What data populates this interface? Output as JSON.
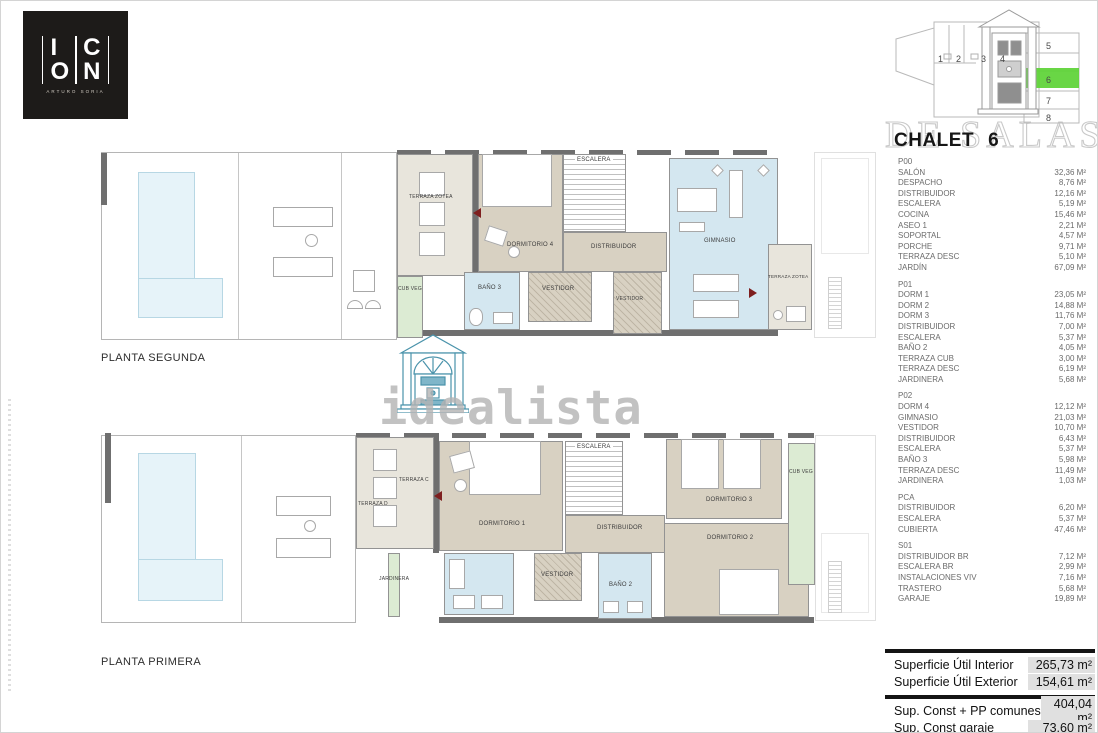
{
  "logo": {
    "row1": [
      "I",
      "C"
    ],
    "row2": [
      "O",
      "N"
    ],
    "subtitle": "ARTURO SORIA"
  },
  "title": {
    "name": "CHALET",
    "number": "6"
  },
  "watermark": {
    "brand": "idealista",
    "agency": "DE SALAS"
  },
  "site_plan": {
    "plots": [
      "1",
      "2",
      "3",
      "4",
      "5",
      "6",
      "7",
      "8"
    ],
    "highlighted": "6",
    "highlight_color": "#5cd335"
  },
  "floor_labels": {
    "upper": "PLANTA SEGUNDA",
    "lower": "PLANTA PRIMERA"
  },
  "plan_upper": {
    "rooms": {
      "terraza_zotea_left": "TERRAZA ZOTEA",
      "cub_veg": "CUB VEG",
      "dormitorio4": "DORMITORIO 4",
      "escalera": "ESCALERA",
      "distribuidor": "DISTRIBUIDOR",
      "bano3": "BAÑO 3",
      "vestidor1": "VESTIDOR",
      "vestidor2": "VESTIDOR",
      "gimnasio": "GIMNASIO",
      "terraza_zotea_right": "TERRAZA ZOTEA"
    }
  },
  "plan_lower": {
    "rooms": {
      "terraza_c": "TERRAZA C",
      "terraza_d": "TERRAZA D",
      "jardinera": "JARDINERA",
      "dormitorio1": "DORMITORIO 1",
      "escalera": "ESCALERA",
      "distribuidor": "DISTRIBUIDOR",
      "vestidor": "VESTIDOR",
      "bano2": "BAÑO 2",
      "dormitorio3": "DORMITORIO 3",
      "dormitorio2": "DORMITORIO 2",
      "cub_veg": "CUB VEG"
    }
  },
  "area_sections": [
    {
      "code": "P00",
      "rows": [
        {
          "label": "SALÓN",
          "value": "32,36 M²"
        },
        {
          "label": "DESPACHO",
          "value": "8,76 M²"
        },
        {
          "label": "DISTRIBUIDOR",
          "value": "12,16 M²"
        },
        {
          "label": "ESCALERA",
          "value": "5,19 M²"
        },
        {
          "label": "COCINA",
          "value": "15,46 M²"
        },
        {
          "label": "ASEO 1",
          "value": "2,21 M²"
        },
        {
          "label": "SOPORTAL",
          "value": "4,57 M²"
        },
        {
          "label": "PORCHE",
          "value": "9,71 M²"
        },
        {
          "label": "TERRAZA DESC",
          "value": "5,10 M²"
        },
        {
          "label": "JARDÍN",
          "value": "67,09 M²"
        }
      ]
    },
    {
      "code": "P01",
      "rows": [
        {
          "label": "DORM 1",
          "value": "23,05 M²"
        },
        {
          "label": "DORM 2",
          "value": "14,88 M²"
        },
        {
          "label": "DORM 3",
          "value": "11,76 M²"
        },
        {
          "label": "DISTRIBUIDOR",
          "value": "7,00 M²"
        },
        {
          "label": "ESCALERA",
          "value": "5,37 M²"
        },
        {
          "label": "BAÑO 2",
          "value": "4,05 M²"
        },
        {
          "label": "TERRAZA CUB",
          "value": "3,00 M²"
        },
        {
          "label": "TERRAZA DESC",
          "value": "6,19 M²"
        },
        {
          "label": "JARDINERA",
          "value": "5,68 M²"
        }
      ]
    },
    {
      "code": "P02",
      "rows": [
        {
          "label": "DORM 4",
          "value": "12,12 M²"
        },
        {
          "label": "GIMNASIO",
          "value": "21,03 M²"
        },
        {
          "label": "VESTIDOR",
          "value": "10,70 M²"
        },
        {
          "label": "DISTRIBUIDOR",
          "value": "6,43 M²"
        },
        {
          "label": "ESCALERA",
          "value": "5,37 M²"
        },
        {
          "label": "BAÑO 3",
          "value": "5,98 M²"
        },
        {
          "label": "TERRAZA DESC",
          "value": "11,49 M²"
        },
        {
          "label": "JARDINERA",
          "value": "1,03 M²"
        }
      ]
    },
    {
      "code": "PCA",
      "rows": [
        {
          "label": "DISTRIBUIDOR",
          "value": "6,20 M²"
        },
        {
          "label": "ESCALERA",
          "value": "5,37 M²"
        },
        {
          "label": "CUBIERTA",
          "value": "47,46 M²"
        }
      ]
    },
    {
      "code": "S01",
      "rows": [
        {
          "label": "DISTRIBUIDOR BR",
          "value": "7,12 M²"
        },
        {
          "label": "ESCALERA BR",
          "value": "2,99 M²"
        },
        {
          "label": "INSTALACIONES VIV",
          "value": "7,16 M²"
        },
        {
          "label": "TRASTERO",
          "value": "5,68 M²"
        },
        {
          "label": "GARAJE",
          "value": "19,89 M²"
        }
      ]
    }
  ],
  "summary": {
    "groups": [
      [
        {
          "label": "Superficie Útil Interior",
          "value": "265,73 m²"
        },
        {
          "label": "Superficie Útil Exterior",
          "value": "154,61 m²"
        }
      ],
      [
        {
          "label": "Sup. Const + PP comunes",
          "value": "404,04 m²"
        },
        {
          "label": "Sup. Const garaje",
          "value": "73,60 m²"
        }
      ]
    ]
  },
  "colors": {
    "wall": "#6f6f6f",
    "room_taupe": "#d8d1c2",
    "room_beige": "#e8e5dc",
    "room_blue": "#d4e7f0",
    "room_green": "#dcebd3",
    "pool": "#e6f3f9",
    "highlight_green": "#5cd335",
    "brand_teal": "#4a93ab"
  }
}
